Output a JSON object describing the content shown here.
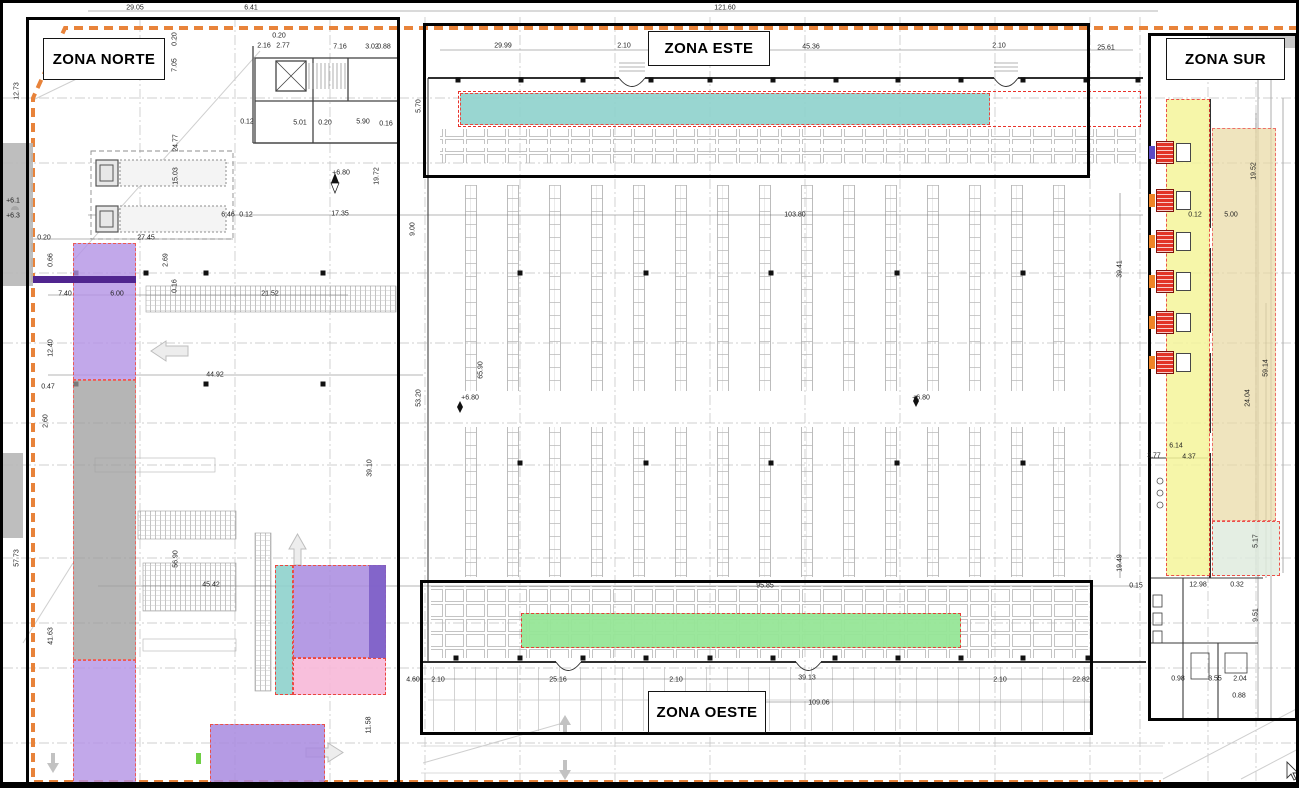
{
  "plan": {
    "title": "Warehouse zoning floor plan",
    "zones": [
      {
        "key": "norte",
        "label": "ZONA NORTE",
        "box": [
          23,
          14,
          374,
          770
        ],
        "label_box": [
          40,
          35,
          122,
          42
        ]
      },
      {
        "key": "este",
        "label": "ZONA ESTE",
        "box": [
          420,
          20,
          667,
          155
        ],
        "label_box": [
          645,
          28,
          122,
          35
        ]
      },
      {
        "key": "sur",
        "label": "ZONA SUR",
        "box": [
          1145,
          30,
          150,
          688
        ],
        "label_box": [
          1163,
          35,
          119,
          42
        ]
      },
      {
        "key": "oeste",
        "label": "ZONA OESTE",
        "box": [
          417,
          577,
          673,
          155
        ],
        "label_box": [
          645,
          688,
          118,
          42
        ]
      }
    ],
    "colors": {
      "boundary_orange": "#e8833a",
      "highlight_border_red": "#e8322a",
      "teal": "#8fd2cd",
      "green": "#96e697",
      "yellow": "#f5f59b",
      "tan": "#e9d9a3",
      "mint": "#e0ecdf",
      "purple": "#a98ae0",
      "dark_purple": "#7d5fc7",
      "gray_corridor": "#9d9d9d",
      "pink": "#f8b9d9",
      "truck_red": "#e23427"
    },
    "overlays": [
      {
        "name": "outside-gray-left-top",
        "x": 0,
        "y": 140,
        "w": 30,
        "h": 143,
        "fill": "#b7b7b7",
        "op": 0.9,
        "border": false
      },
      {
        "name": "outside-gray-left-mid",
        "x": 0,
        "y": 450,
        "w": 20,
        "h": 85,
        "fill": "#b7b7b7",
        "op": 0.9,
        "border": false
      },
      {
        "name": "sur-gray-top-band",
        "x": 1207,
        "y": 32,
        "w": 86,
        "h": 13,
        "fill": "#c2c2c2",
        "op": 0.9,
        "border": false
      },
      {
        "name": "este-highlight-band",
        "x": 455,
        "y": 88,
        "w": 683,
        "h": 36,
        "fill": "none",
        "border": true
      },
      {
        "name": "este-teal-strip",
        "x": 457,
        "y": 90,
        "w": 530,
        "h": 32,
        "fill": "#8fd2cd",
        "op": 0.9,
        "border": true
      },
      {
        "name": "oeste-green-strip",
        "x": 518,
        "y": 610,
        "w": 440,
        "h": 35,
        "fill": "#96e697",
        "op": 0.95,
        "border": true
      },
      {
        "name": "sur-yellow-strip",
        "x": 1163,
        "y": 96,
        "w": 44,
        "h": 477,
        "fill": "#f5f59b",
        "op": 0.85,
        "border": true
      },
      {
        "name": "sur-tan-strip",
        "x": 1209,
        "y": 125,
        "w": 64,
        "h": 393,
        "fill": "#e9d9a3",
        "op": 0.7,
        "border": true
      },
      {
        "name": "sur-mint-rect",
        "x": 1209,
        "y": 518,
        "w": 68,
        "h": 55,
        "fill": "#e0ecdf",
        "op": 0.85,
        "border": true
      },
      {
        "name": "left-purple-top",
        "x": 70,
        "y": 240,
        "w": 63,
        "h": 137,
        "fill": "#b493e6",
        "op": 0.8,
        "border": true
      },
      {
        "name": "left-gray-corridor",
        "x": 70,
        "y": 377,
        "w": 63,
        "h": 280,
        "fill": "#9d9d9d",
        "op": 0.75,
        "border": true
      },
      {
        "name": "left-purple-bottom",
        "x": 70,
        "y": 657,
        "w": 63,
        "h": 126,
        "fill": "#b493e6",
        "op": 0.8,
        "border": true
      },
      {
        "name": "purple-dark-bar",
        "x": 30,
        "y": 273,
        "w": 103,
        "h": 7,
        "fill": "#50258f",
        "op": 1,
        "border": false
      },
      {
        "name": "mid-teal-strip",
        "x": 272,
        "y": 562,
        "w": 18,
        "h": 130,
        "fill": "#8fd2cd",
        "op": 0.9,
        "border": true
      },
      {
        "name": "mid-purple-rect",
        "x": 290,
        "y": 562,
        "w": 93,
        "h": 93,
        "fill": "#a98ae0",
        "op": 0.85,
        "border": true
      },
      {
        "name": "mid-dark-purple-edge",
        "x": 366,
        "y": 562,
        "w": 17,
        "h": 93,
        "fill": "#7d5fc7",
        "op": 0.9,
        "border": false
      },
      {
        "name": "mid-pink-rect",
        "x": 290,
        "y": 655,
        "w": 93,
        "h": 37,
        "fill": "#f8b9d9",
        "op": 0.9,
        "border": true
      },
      {
        "name": "bottom-purple-rect",
        "x": 207,
        "y": 721,
        "w": 115,
        "h": 60,
        "fill": "#a98ae0",
        "op": 0.85,
        "border": true
      },
      {
        "name": "green-marker",
        "x": 193,
        "y": 750,
        "w": 5,
        "h": 11,
        "fill": "#6fcf44",
        "op": 1,
        "border": false
      }
    ],
    "dimensions": [
      [
        "29.05",
        132,
        5
      ],
      [
        "6.41",
        248,
        5
      ],
      [
        "121.60",
        722,
        5
      ],
      [
        "29.99",
        500,
        43
      ],
      [
        "2.10",
        621,
        43
      ],
      [
        "45.36",
        808,
        44
      ],
      [
        "2.10",
        996,
        43
      ],
      [
        "25.61",
        1103,
        45
      ],
      [
        "0.20",
        276,
        33
      ],
      [
        "2.16",
        261,
        43
      ],
      [
        "2.77",
        280,
        43
      ],
      [
        "7.16",
        337,
        44
      ],
      [
        "3.02",
        369,
        44
      ],
      [
        "0.88",
        381,
        44
      ],
      [
        "0.12",
        244,
        119
      ],
      [
        "5.01",
        297,
        120
      ],
      [
        "0.20",
        322,
        120
      ],
      [
        "5.90",
        360,
        119
      ],
      [
        "0.16",
        383,
        121
      ],
      [
        "12.73",
        14,
        88,
        1
      ],
      [
        "0.20",
        172,
        36,
        1
      ],
      [
        "7.05",
        172,
        62,
        1
      ],
      [
        "24.77",
        173,
        140,
        1
      ],
      [
        "15.03",
        173,
        173,
        1
      ],
      [
        "19.72",
        374,
        173,
        1
      ],
      [
        "5.70",
        416,
        103,
        1
      ],
      [
        "9.00",
        410,
        226,
        1
      ],
      [
        "+6.80",
        338,
        170
      ],
      [
        "6.46",
        225,
        212
      ],
      [
        "0.12",
        243,
        212
      ],
      [
        "17.35",
        337,
        211
      ],
      [
        "0.20",
        41,
        235
      ],
      [
        "27.45",
        143,
        235
      ],
      [
        "2.69",
        163,
        257,
        1
      ],
      [
        "0.66",
        48,
        257,
        1
      ],
      [
        "7.40",
        62,
        291
      ],
      [
        "6.00",
        114,
        291
      ],
      [
        "21.52",
        267,
        291
      ],
      [
        "0.16",
        172,
        283,
        1
      ],
      [
        "12.40",
        48,
        345,
        1
      ],
      [
        "44.92",
        212,
        372
      ],
      [
        "0.47",
        45,
        384
      ],
      [
        "2.60",
        43,
        418,
        1
      ],
      [
        "39.10",
        367,
        465,
        1
      ],
      [
        "57.73",
        14,
        555,
        1
      ],
      [
        "56.90",
        173,
        556,
        1
      ],
      [
        "41.63",
        48,
        633,
        1
      ],
      [
        "45.42",
        208,
        582
      ],
      [
        "11.58",
        366,
        722,
        1
      ],
      [
        "103.80",
        792,
        212
      ],
      [
        "53.20",
        416,
        395,
        1
      ],
      [
        "65.90",
        478,
        367,
        1
      ],
      [
        "+6.80",
        467,
        395
      ],
      [
        "+6.80",
        918,
        395
      ],
      [
        "95.85",
        762,
        583
      ],
      [
        "109.06",
        816,
        700
      ],
      [
        "39.13",
        804,
        675
      ],
      [
        "4.60",
        410,
        677
      ],
      [
        "2.10",
        435,
        677
      ],
      [
        "25.16",
        555,
        677
      ],
      [
        "2.10",
        673,
        677
      ],
      [
        "2.10",
        997,
        677
      ],
      [
        "22.82",
        1078,
        677
      ],
      [
        "0.15",
        1133,
        583
      ],
      [
        "19.49",
        1117,
        560,
        1
      ],
      [
        "39.41",
        1117,
        266,
        1
      ],
      [
        "19.52",
        1251,
        168,
        1
      ],
      [
        "0.12",
        1192,
        212
      ],
      [
        "5.00",
        1228,
        212
      ],
      [
        "59.14",
        1263,
        365,
        1
      ],
      [
        "24.04",
        1245,
        395,
        1
      ],
      [
        "6.14",
        1173,
        443
      ],
      [
        "4.37",
        1186,
        454
      ],
      [
        "3.77",
        1151,
        453
      ],
      [
        "5.17",
        1253,
        538,
        1
      ],
      [
        "12.98",
        1195,
        582
      ],
      [
        "0.32",
        1234,
        582
      ],
      [
        "9.51",
        1253,
        612,
        1
      ],
      [
        "0.98",
        1175,
        676
      ],
      [
        "3.55",
        1212,
        676
      ],
      [
        "2.04",
        1237,
        676
      ],
      [
        "0.88",
        1236,
        693
      ],
      [
        "+6.1",
        10,
        198
      ],
      [
        "+6.3",
        10,
        213
      ]
    ],
    "trucks_sur": {
      "x": 1146,
      "ys": [
        138,
        186,
        227,
        267,
        308,
        348
      ],
      "tick_colors": [
        "#5b4bc4",
        "#ef8426",
        "#ef8426",
        "#ef8426",
        "#ef8426",
        "#ef8426"
      ]
    }
  }
}
